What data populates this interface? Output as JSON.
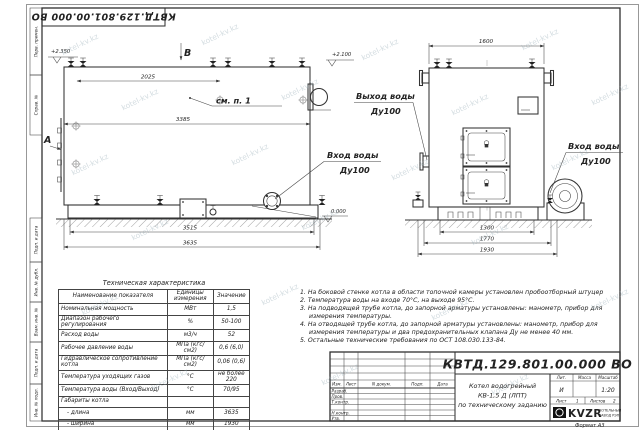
{
  "watermark": {
    "text": "kotel-kv.kz"
  },
  "frame": {
    "doc_number_top": "КВТД.129.801.00.000  ВО",
    "format_label": "Формат  А3",
    "side_labels": [
      "Перв. примен.",
      "Справ. №",
      "Подп. и дата",
      "Инв. № дубл.",
      "Взам. инв. №",
      "Подп. и дата",
      "Инв. № подл."
    ]
  },
  "drawing": {
    "view_side": {
      "view_letter_top": "В",
      "view_letter_left": "А",
      "callout": "см. п. 1",
      "dim_top": "2025",
      "dim_length": "3385",
      "dim_base": "3515",
      "dim_overall": "3635",
      "elev_top_left": "+2.350",
      "elev_top_right": "+2.100",
      "elev_zero": "0.000"
    },
    "view_front": {
      "dim_top": "1600",
      "dim_base": "1300",
      "dim_mid": "1770",
      "dim_overall": "1930"
    },
    "labels": {
      "water_out_1": "Выход воды",
      "water_out_2": "Ду100",
      "water_in_side_1": "Вход воды",
      "water_in_side_2": "Ду100",
      "water_in_front_1": "Вход воды",
      "water_in_front_2": "Ду100"
    }
  },
  "spec_table": {
    "title": "Техническая характеристика",
    "headers": [
      "Наименование показателя",
      "Единицы измерения",
      "Значение"
    ],
    "rows": [
      [
        "Номинальная мощность",
        "МВт",
        "1,5"
      ],
      [
        "Диапазон рабочего регулирования",
        "%",
        "50-100"
      ],
      [
        "Расход воды",
        "м3/ч",
        "52"
      ],
      [
        "Рабочее давление воды",
        "МПа (кгс/см2)",
        "0,6 (6,0)"
      ],
      [
        "Гидравлическое сопротивление котла",
        "МПа (кгс/см2)",
        "0,06 (0,6)"
      ],
      [
        "Температура уходящих газов",
        "°С",
        "не более 220"
      ],
      [
        "Температура воды (Вход/Выход)",
        "°С",
        "70/95"
      ],
      [
        "Габариты котла",
        "",
        ""
      ],
      [
        "- длина",
        "мм",
        "3635"
      ],
      [
        "- ширина",
        "мм",
        "1930"
      ],
      [
        "- высота",
        "мм",
        "2250"
      ]
    ]
  },
  "notes": {
    "items": [
      "1.  На боковой стенке котла в области топочной камеры установлен пробоотборный штуцер",
      "2.  Температура воды на входе 70°С, на выходе 95°С.",
      "3.  На подводящей трубе котла, до запорной арматуры установлены: манометр, прибор для измерения температуры.",
      "4.  На отводящей трубе котла, до запорной арматуры установлены: манометр, прибор для измерения температуры и два предохранительных клапана Ду не менее 40 мм.",
      "5.  Остальные технические требования по ОСТ 108.030.133-84."
    ]
  },
  "title_block": {
    "doc_number": "КВТД.129.801.00.000  ВО",
    "name_line1": "Котел водогрейный",
    "name_line2": "КВ-1,5  Д  (ЛПТ)",
    "name_line3": "по техническому заданию",
    "col_izm": "Изм.",
    "col_list": "Лист",
    "col_ndok": "N докум.",
    "col_podp": "Подп.",
    "col_data": "Дата",
    "row_razrab": "Разраб.",
    "row_prov": "Пров.",
    "row_tkontr": "Т.контр.",
    "row_nkontr": "Н.контр.",
    "row_utv": "Утв.",
    "lit_label": "Лит.",
    "lit_value": "И",
    "mass_label": "Масса",
    "scale_label": "Масштаб",
    "scale_value": "1:20",
    "sheet_label": "Лист",
    "sheet_value": "1",
    "sheets_label": "Листов",
    "sheets_value": "2",
    "logo_text": "KVZR",
    "logo_cap1": "КОТЕЛЬНЫЙ",
    "logo_cap2": "ЗАВОД РЭП"
  }
}
